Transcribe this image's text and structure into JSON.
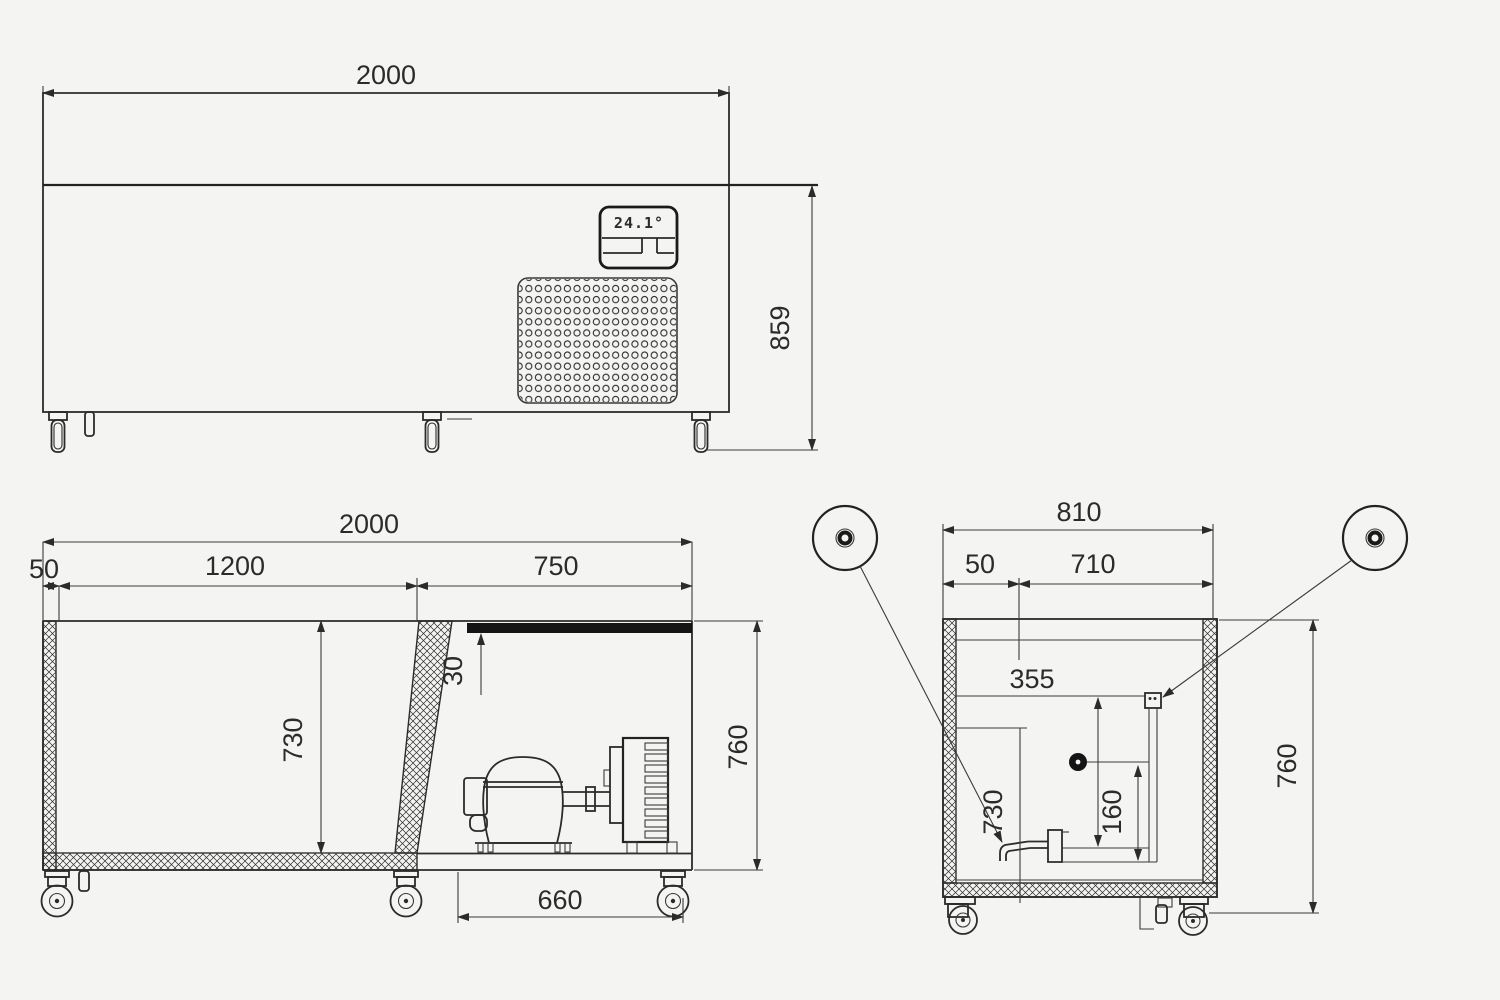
{
  "views": {
    "front": {
      "dim_width": "2000",
      "dim_height": "859",
      "display_readout": "24.1°"
    },
    "section_long": {
      "dim_overall_width": "2000",
      "dim_tank_width": "1200",
      "dim_machine_width": "750",
      "dim_wall_thickness": "50",
      "dim_tank_depth": "730",
      "dim_worktop_thickness": "30",
      "dim_body_height": "760",
      "dim_machine_base": "660"
    },
    "section_cross": {
      "dim_overall_width": "810",
      "dim_wall_thickness": "50",
      "dim_inner_width": "710",
      "dim_mid_depth": "355",
      "dim_drain_height": "160",
      "dim_tank_depth": "730",
      "dim_body_height": "760"
    }
  },
  "colors": {
    "background": "#f4f4f2",
    "ink": "#2b2b2b",
    "band": "#141414"
  }
}
